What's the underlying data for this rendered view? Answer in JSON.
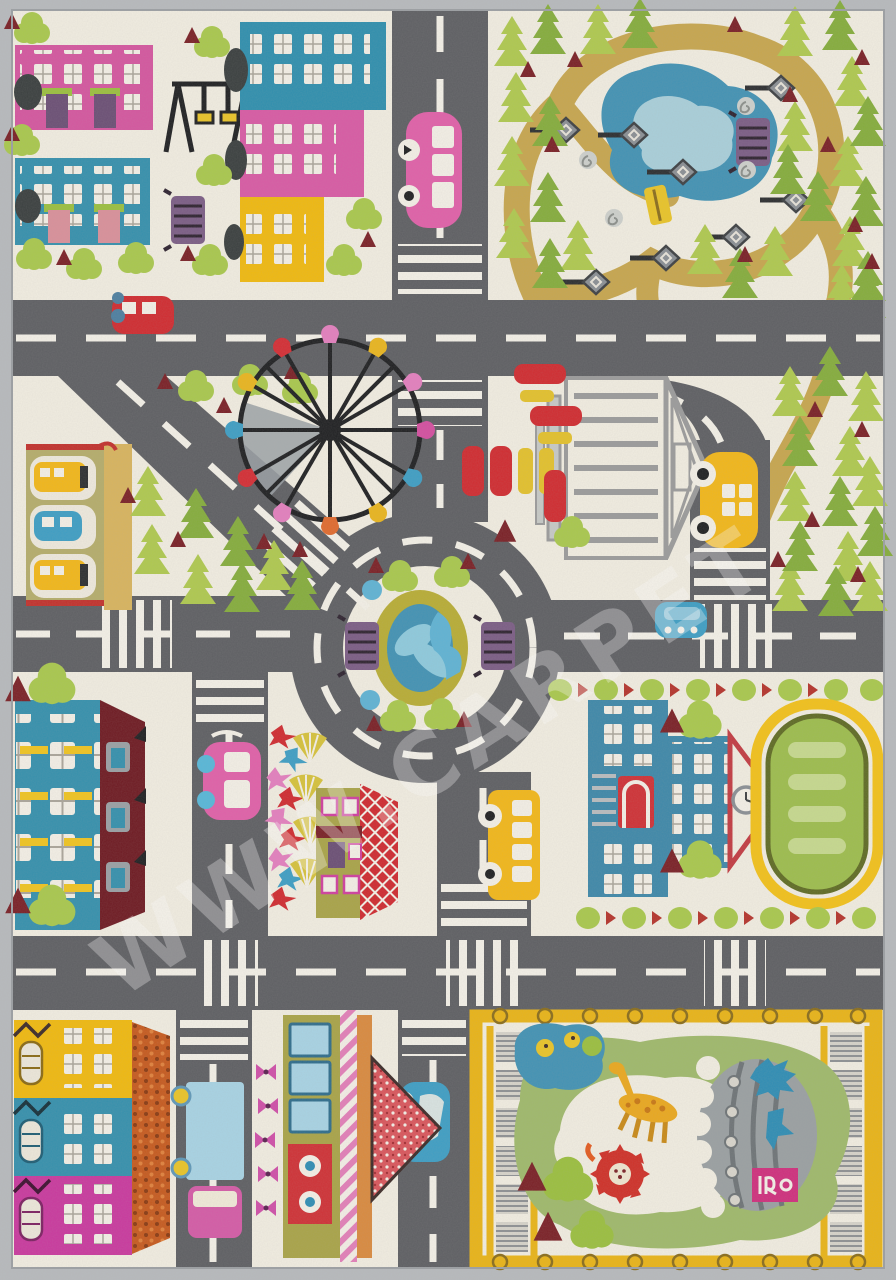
{
  "watermark": {
    "text": "WWW.CARPET"
  },
  "palette": {
    "rug_edge": "#b7babd",
    "background": "#f1ede1",
    "road": "#5e5f63",
    "road_marking": "#f3f0e7",
    "park_path": "#c7a64e",
    "pond": "#4292b4",
    "pond_light": "#a9cfda",
    "pine_light": "#afc94f",
    "pine_dark": "#85ad3c",
    "tree_green": "#a9c84d",
    "maroon": "#7a2026",
    "pink_building": "#d4569f",
    "teal_building": "#3590ad",
    "yellow_building": "#f0b90f",
    "red": "#d02b30",
    "vehicle_yellow": "#f2b719",
    "vehicle_pink": "#e060a8",
    "vehicle_blue": "#3e9ec4",
    "purple": "#7b5d85",
    "olive": "#a9a448",
    "orange_roof": "#c65a1e",
    "school_blue": "#3e88a9",
    "track_green": "#9dbd4d",
    "track_yellow": "#f2c11a",
    "zoo_green": "#9fb96b",
    "zoo_fence": "#e9b417",
    "gazebo_gray": "#9b9b9b",
    "dark_red_roof": "#6e1a22"
  }
}
